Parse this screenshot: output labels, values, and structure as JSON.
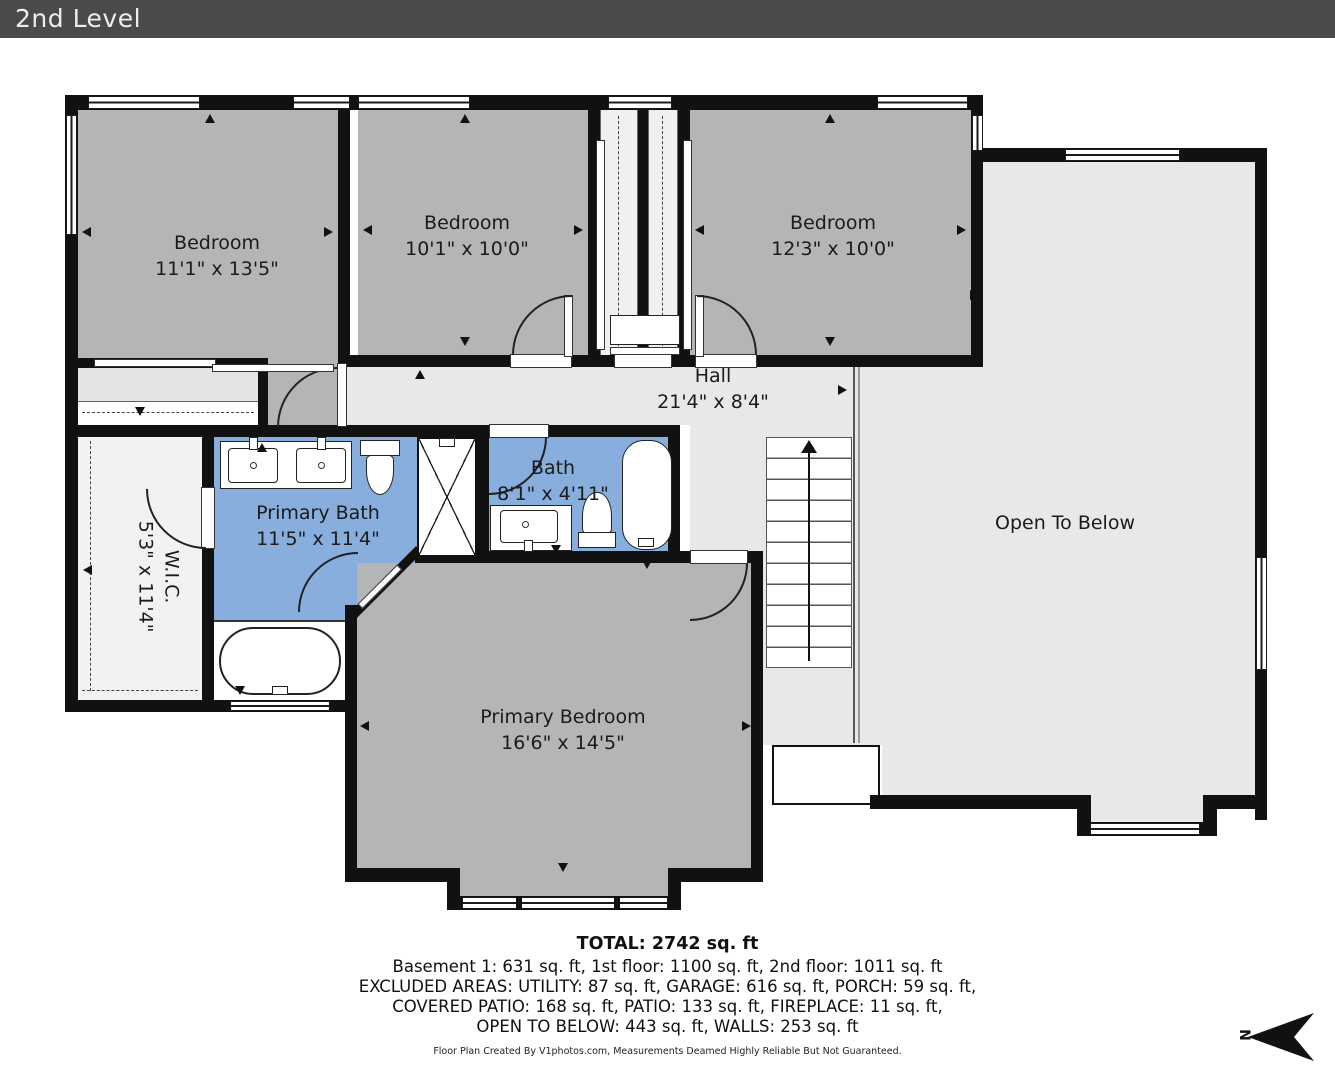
{
  "header": {
    "title": "2nd Level"
  },
  "rooms": {
    "bedroom_tl": {
      "name": "Bedroom",
      "dims": "11'1\" x 13'5\""
    },
    "bedroom_mid": {
      "name": "Bedroom",
      "dims": "10'1\" x 10'0\""
    },
    "bedroom_right": {
      "name": "Bedroom",
      "dims": "12'3\" x 10'0\""
    },
    "hall": {
      "name": "Hall",
      "dims": "21'4\" x 8'4\""
    },
    "bath": {
      "name": "Bath",
      "dims": "8'1\" x 4'11\""
    },
    "primary_bath": {
      "name": "Primary Bath",
      "dims": "11'5\" x 11'4\""
    },
    "wic": {
      "name": "W.I.C.",
      "dims": "5'3\" x 11'4\""
    },
    "primary_bedroom": {
      "name": "Primary Bedroom",
      "dims": "16'6\" x 14'5\""
    },
    "open_below": {
      "name": "Open To Below"
    }
  },
  "summary": {
    "total": "TOTAL: 2742 sq. ft",
    "line1": "Basement 1: 631 sq. ft, 1st floor: 1100 sq. ft, 2nd floor: 1011 sq. ft",
    "line2": "EXCLUDED AREAS: UTILITY: 87 sq. ft, GARAGE: 616 sq. ft, PORCH: 59 sq. ft,",
    "line3": "COVERED PATIO: 168 sq. ft, PATIO: 133 sq. ft, FIREPLACE: 11 sq. ft,",
    "line4": "OPEN TO BELOW: 443 sq. ft, WALLS: 253 sq. ft"
  },
  "credit": "Floor Plan Created By V1photos.com, Measurements Deamed Highly Reliable But Not Guaranteed.",
  "compass": {
    "label": "N"
  },
  "colors": {
    "wall": "#111111",
    "bedroom_gray": "#b5b5b5",
    "open_gray": "#e8e8e8",
    "bath_blue": "#87aedd",
    "header_bg": "#4a4a4a"
  }
}
